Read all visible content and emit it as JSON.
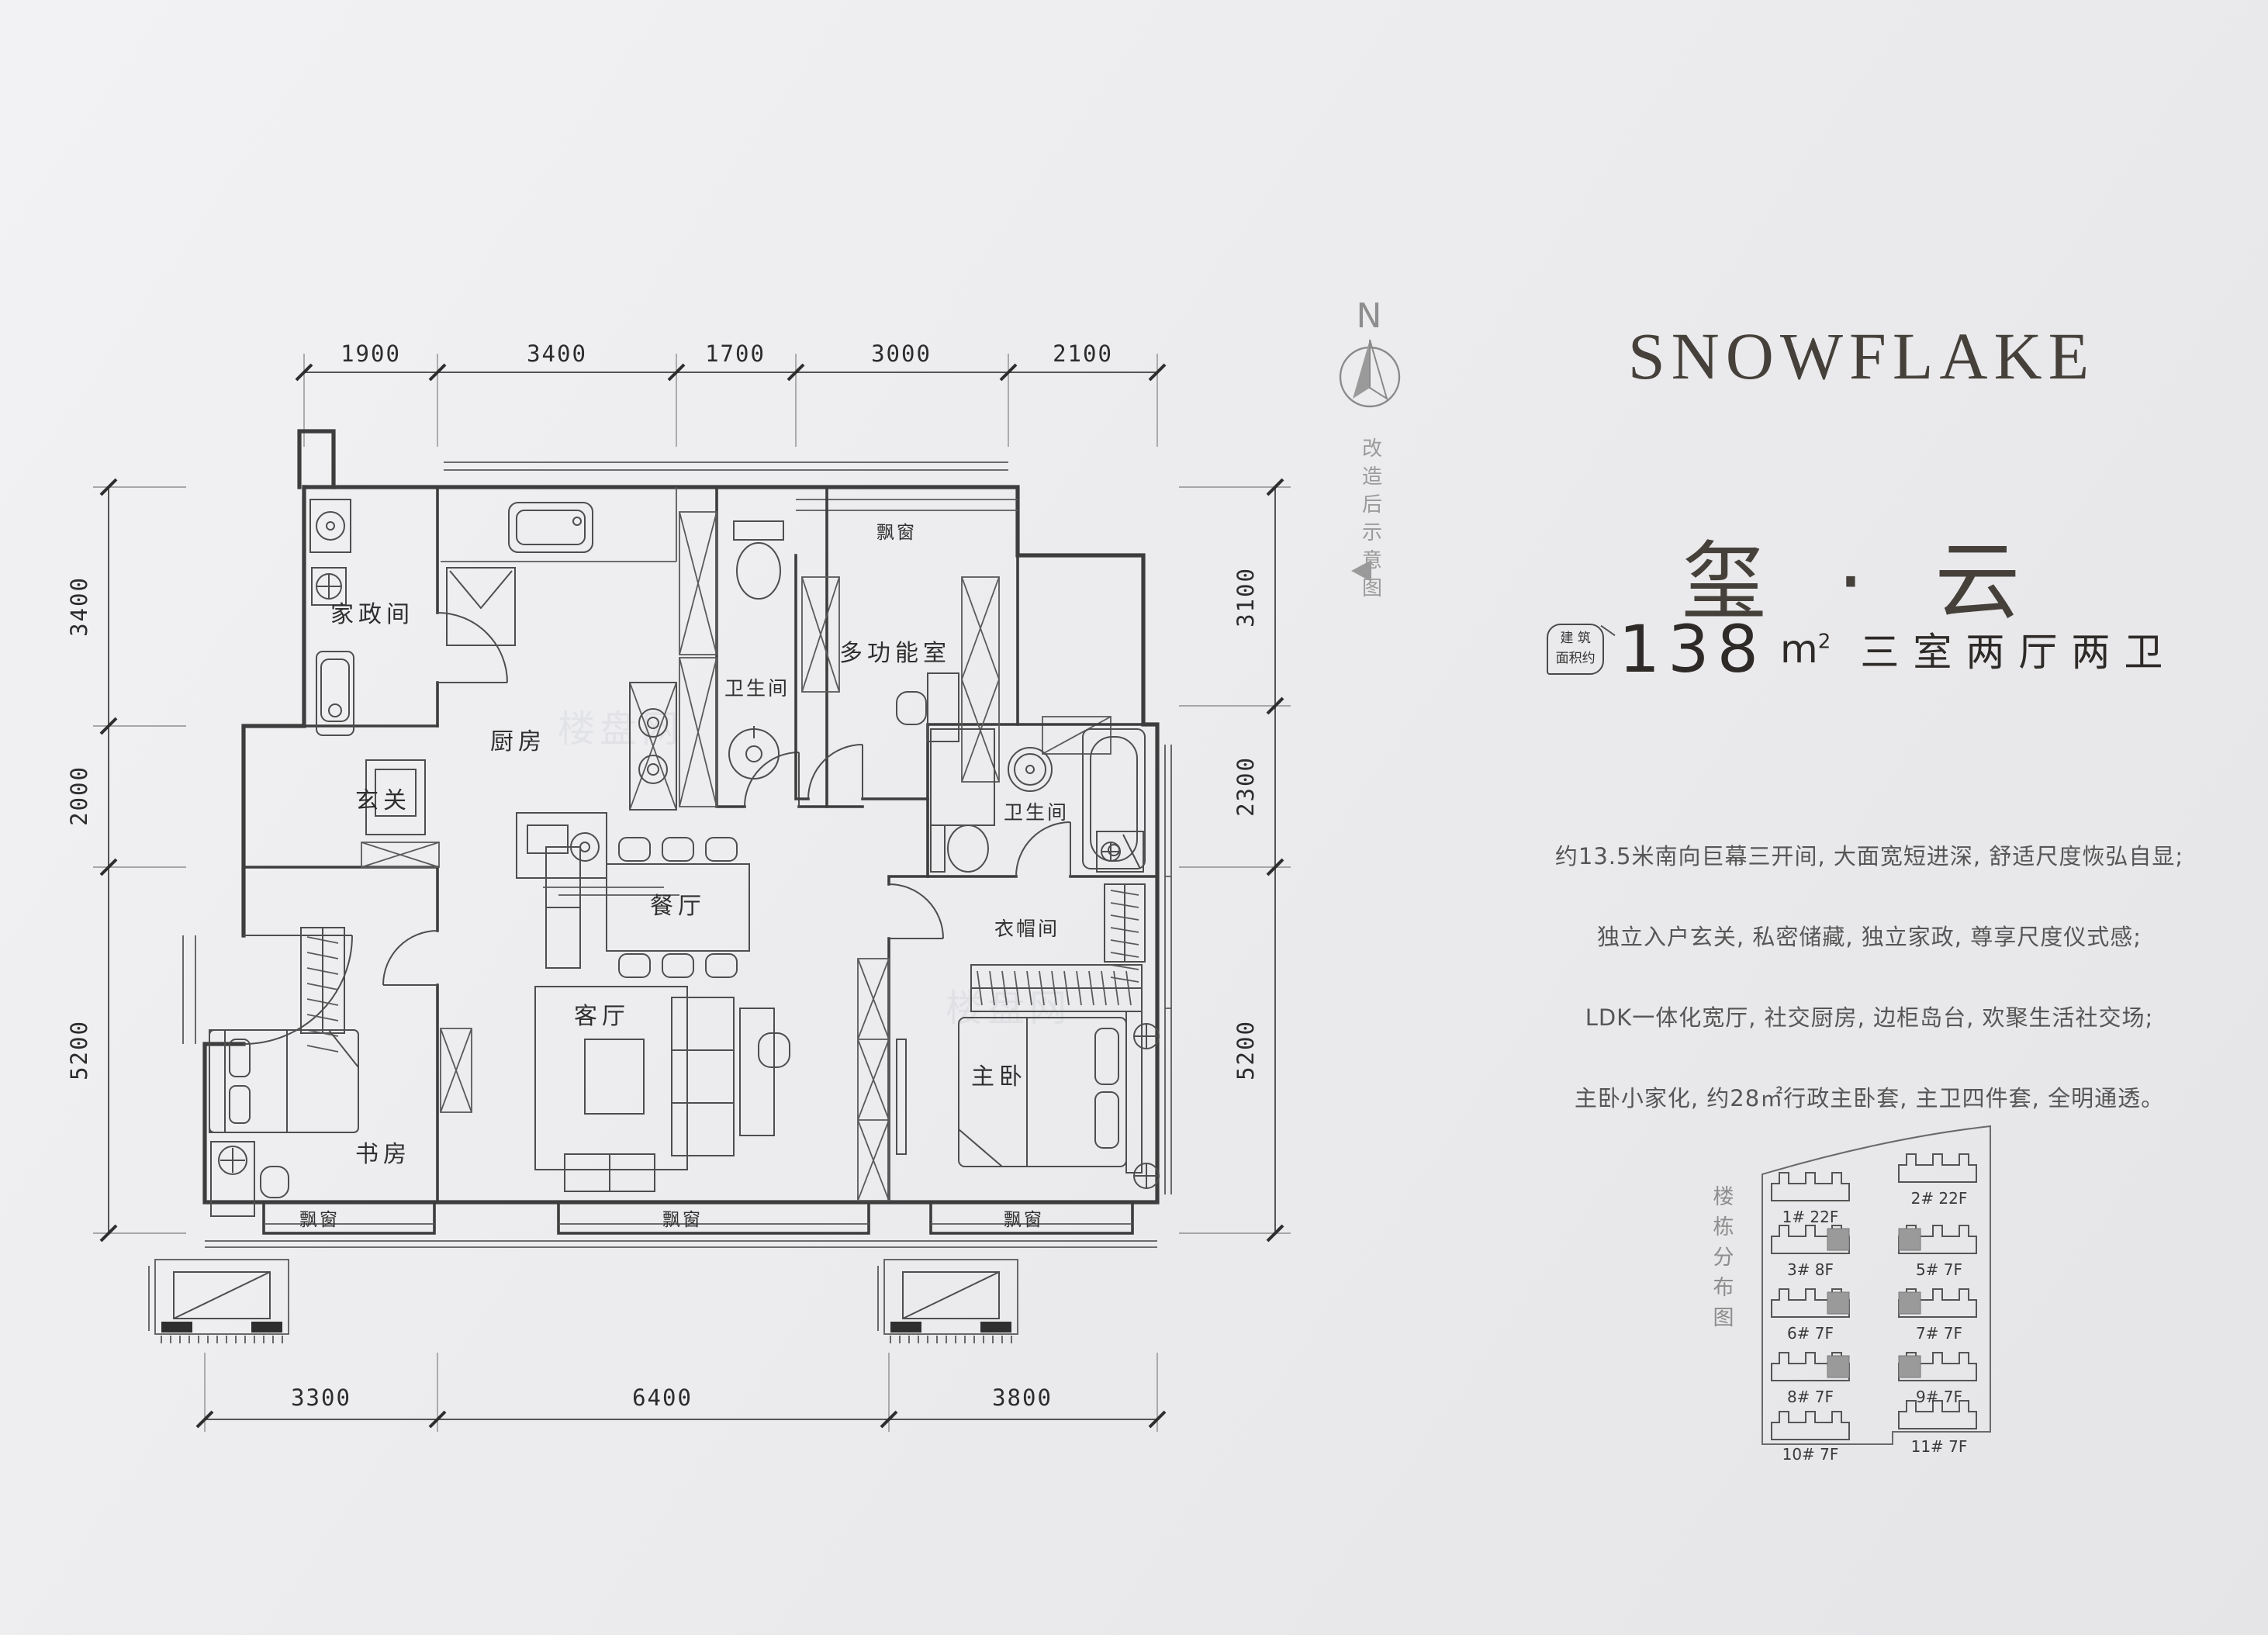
{
  "compass": {
    "n": "N",
    "note": "改造后示意图"
  },
  "brand": {
    "title_en": "SNOWFLAKE",
    "title_cn": "玺 · 云"
  },
  "area": {
    "badge_line1": "建 筑",
    "badge_line2": "面积约",
    "value": "138",
    "unit": "m",
    "sup": "2",
    "layout": "三室两厅两卫"
  },
  "desc": {
    "lines": [
      "约13.5米南向巨幕三开间, 大面宽短进深, 舒适尺度恢弘自显;",
      "独立入户玄关, 私密储藏, 独立家政, 尊享尺度仪式感;",
      "LDK一体化宽厅, 社交厨房, 边柜岛台, 欢聚生活社交场;",
      "主卧小家化, 约28㎡行政主卧套, 主卫四件套, 全明通透。"
    ]
  },
  "plan": {
    "rooms": {
      "laundry": "家政间",
      "kitchen": "厨房",
      "bath_a": "卫生间",
      "multi": "多功能室",
      "foyer": "玄关",
      "dining": "餐厅",
      "living": "客厅",
      "study": "书房",
      "master": "主卧",
      "cloak": "衣帽间",
      "bath_b": "卫生间",
      "bay": "飘窗"
    },
    "dims": {
      "top": [
        "1900",
        "3400",
        "1700",
        "3000",
        "2100"
      ],
      "bottom": [
        "3300",
        "6400",
        "3800"
      ],
      "left": [
        "3400",
        "2000",
        "5200"
      ],
      "right": [
        "3100",
        "2300",
        "5200"
      ]
    }
  },
  "sitemap": {
    "label": "楼栋分布图",
    "buildings": [
      "1# 22F",
      "2# 22F",
      "3# 8F",
      "5# 7F",
      "6# 7F",
      "7# 7F",
      "8# 7F",
      "9# 7F",
      "10# 7F",
      "11# 7F"
    ]
  },
  "watermark": {
    "text": "楼盘网"
  }
}
